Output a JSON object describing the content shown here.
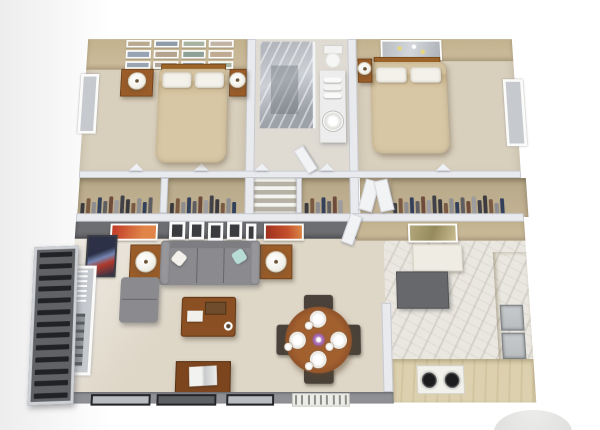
{
  "meta": {
    "description": "3D top-down isometric render of a two-bedroom apartment floor plan",
    "render_type": "architectural-3d-floorplan"
  },
  "palette": {
    "bg-left": "#ededee",
    "wall": "#e8eaee",
    "wall-edge": "#c6c9d1",
    "wall-top": "#cfd3d9",
    "tan-wall": "#c2b28d",
    "tan-wall2": "#ccbc9d",
    "carpet": "#d8cfbc",
    "bath-floor": "#dfdbd3",
    "living-floor": "#ded6c7",
    "marble": "#eae7e0",
    "shower": "#b4b8be",
    "shower-dark": "#9da1a8",
    "gray-band": "#6d6e72",
    "front-wall": "#8e9095",
    "cabinet": "#d6c8a5",
    "counter": "#dcd0ae",
    "dark-counter": "#66686b",
    "steel": "#b9bdc0",
    "wood": "#9a5c28",
    "wood-dark": "#8a4f22",
    "wood-deep": "#7c451e",
    "headboard": "#9c6428",
    "duvet": "#d8c7a5",
    "duvet-dark": "#c9b48d",
    "pillow": "#f3f1ea",
    "sofa": "#8b8b8f",
    "sofa-light": "#97979b",
    "sofa-dark": "#7e7e82",
    "teal": "#b7dcd6",
    "chair": "#4a423a",
    "table-top": "#8a4e28",
    "railing": "#212225",
    "railing-gap": "#616266",
    "glass": "#c6cacf",
    "closet-bg": "#c3b394",
    "art-red": "#c03a28",
    "art-orange": "#c4502c",
    "art-blue": "#2c3147",
    "art-olive": "#958a5e",
    "centerpiece-purple": "#a86fb5",
    "dome": "#dfe0dd"
  },
  "counts": {
    "gallery_frames": 12,
    "railing_slats": 13,
    "blind_slats": 7,
    "grate_slats": 9,
    "burners": 2,
    "place_settings": 4,
    "dining_chairs": 4
  },
  "closets": {
    "racks": [
      13,
      12,
      7,
      20
    ]
  },
  "clothes_colors": [
    "#3b3b3f",
    "#7a5a42",
    "#8d8d92",
    "#33415c",
    "#5d5d62",
    "#6e4b3a",
    "#9c9ca1",
    "#41414a"
  ],
  "gallery_photo_colors": [
    "#b9a98f",
    "#8f9aa8",
    "#a8b2a0",
    "#c2b4a4",
    "#97a3b4",
    "#b4a48e",
    "#8fa096",
    "#c0aa92",
    "#9aa5b1",
    "#b0a699",
    "#93a0ad",
    "#a9b3a2"
  ],
  "rooms": [
    {
      "id": "bedroom-1",
      "furniture": [
        "gallery-wall",
        "double-bed",
        "headboard",
        "nightstand",
        "table-lamp",
        "window",
        "closets-with-clothes"
      ]
    },
    {
      "id": "bathroom",
      "furniture": [
        "marble-shower",
        "vanity",
        "round-sink",
        "towels",
        "toilet",
        "linen-shelves"
      ]
    },
    {
      "id": "bedroom-2",
      "furniture": [
        "wall-art",
        "double-bed",
        "headboard",
        "side-table",
        "table-lamp",
        "window",
        "closet-with-clothes",
        "closet-doors"
      ]
    },
    {
      "id": "living-room",
      "furniture": [
        "sofa",
        "chaise",
        "end-table",
        "table-lamp",
        "coffee-table",
        "media-console",
        "tv",
        "wall-shelf",
        "wall-art",
        "poster",
        "balcony-door"
      ]
    },
    {
      "id": "dining-area",
      "furniture": [
        "round-dining-table",
        "dining-chair",
        "place-setting",
        "flower-centerpiece"
      ]
    },
    {
      "id": "kitchen",
      "furniture": [
        "upper-cabinet",
        "dark-countertop",
        "cabinet-run",
        "double-sink",
        "counter",
        "stove",
        "wall-art"
      ]
    },
    {
      "id": "balcony",
      "furniture": [
        "railing"
      ]
    }
  ]
}
